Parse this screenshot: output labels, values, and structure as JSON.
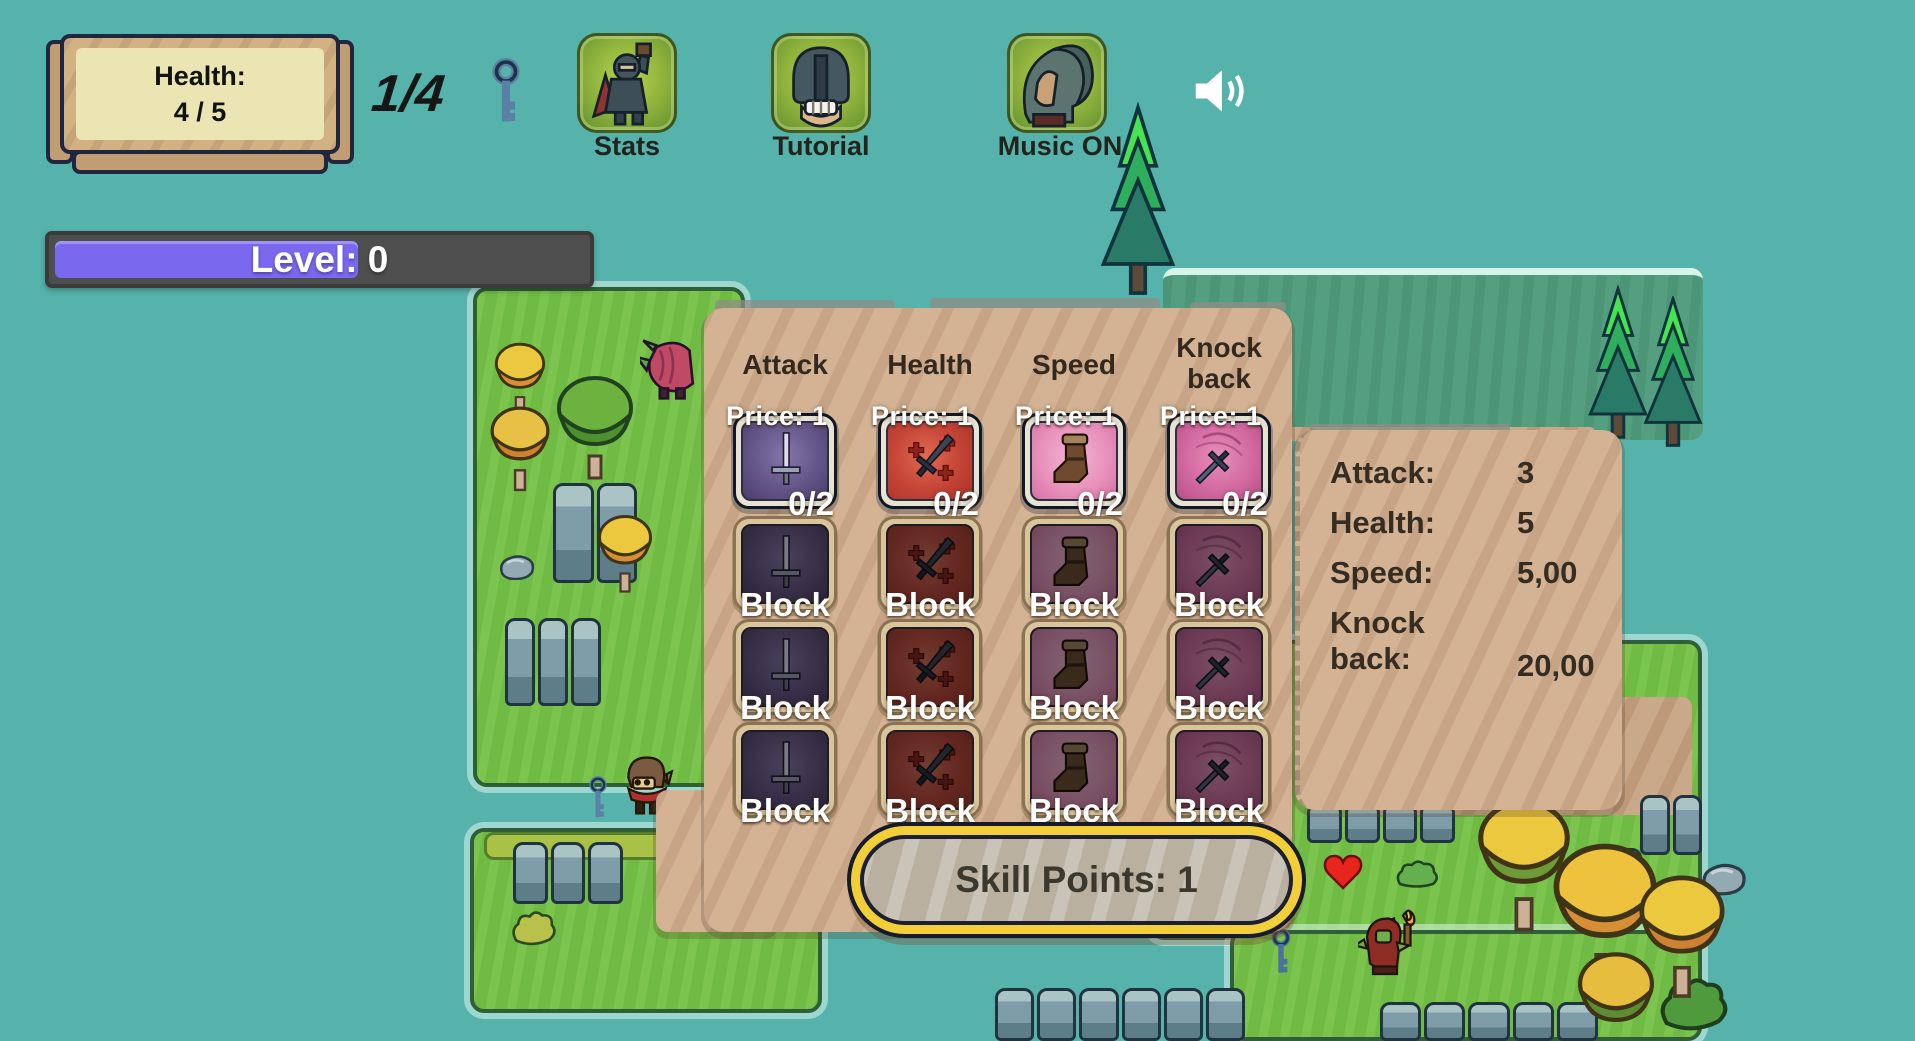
{
  "hud": {
    "health_banner": {
      "label": "Health:",
      "value": "4 / 5"
    },
    "keys_counter": "1/4",
    "icons": {
      "key": "key-icon",
      "speaker": "speaker-on-icon"
    },
    "top_buttons": [
      {
        "id": "stats",
        "label": "Stats"
      },
      {
        "id": "tutorial",
        "label": "Tutorial"
      },
      {
        "id": "music",
        "label": "Music ON"
      }
    ],
    "level_bar": {
      "text": "Level: 0",
      "fill_percent": 56
    }
  },
  "skill_panel": {
    "columns": [
      {
        "name": "Attack",
        "price": "Price: 1",
        "progress": "0/2"
      },
      {
        "name": "Health",
        "price": "Price: 1",
        "progress": "0/2"
      },
      {
        "name": "Speed",
        "price": "Price: 1",
        "progress": "0/2"
      },
      {
        "name": "Knock back",
        "price": "Price: 1",
        "progress": "0/2"
      }
    ],
    "block_label": "Block",
    "skill_points": "Skill Points: 1"
  },
  "stats_panel": {
    "rows": [
      {
        "label": "Attack:",
        "value": "3"
      },
      {
        "label": "Health:",
        "value": "5"
      },
      {
        "label": "Speed:",
        "value": "5,00"
      },
      {
        "label": "Knock back:",
        "value": "20,00"
      }
    ]
  },
  "map": {
    "sprites": [
      "pine-tree",
      "autumn-tree",
      "cliff",
      "heart-pickup",
      "key-pickup",
      "player-character",
      "goblin-torchbearer",
      "boar-monster",
      "bush",
      "rock"
    ]
  },
  "colors": {
    "background_teal": "#55b3ab",
    "panel_tan": "#d3b394",
    "level_fill_purple": "#7a68ef",
    "level_track_gray": "#4e4e4e",
    "button_gold": "#f2cf39",
    "grass_green": "#74c145"
  }
}
